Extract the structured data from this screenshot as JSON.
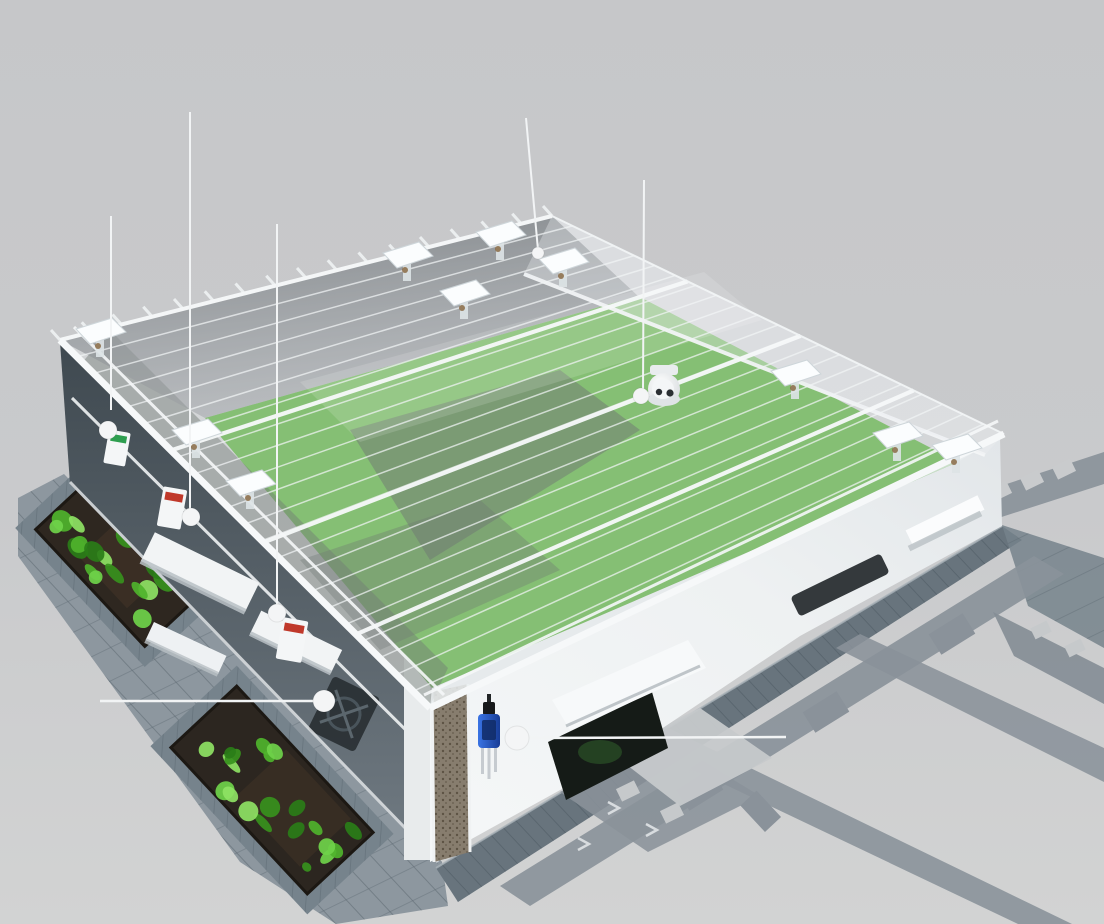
{
  "annotations": {
    "co2": {
      "line1": "二氧化碳",
      "line2": "传感器"
    },
    "air_temp_humidity": {
      "line1": "空气温湿度",
      "line2": "传感器"
    },
    "light_intensity": {
      "line1": "光照度",
      "line2": "传感器"
    },
    "skylight": {
      "label": "天窗"
    },
    "camera": {
      "label": "摄像头"
    },
    "fan": {
      "label": "风机"
    },
    "soil_moisture": {
      "label": "土壤墒情传感器"
    }
  },
  "scene": {
    "icons": [
      "camera-icon",
      "soil-sensor-icon",
      "skylight-vent-icon",
      "fan-unit-icon",
      "sensor-box-icon"
    ],
    "colors": {
      "background": "#c8c9cb",
      "label_text": "#f2f4f5",
      "callout_line": "#f2f4f5",
      "structure_white": "#f3f5f6",
      "crop_green": "#58a93d",
      "plant_green": "#4fb32c",
      "glass_dark": "#565e66",
      "pavement_gray": "#8d979f",
      "plaza_path_gray": "#8a929a",
      "soil_sensor_blue": "#2458c8",
      "sensor_label_red": "#c0392b",
      "sensor_label_green": "#2e9e4f"
    }
  }
}
